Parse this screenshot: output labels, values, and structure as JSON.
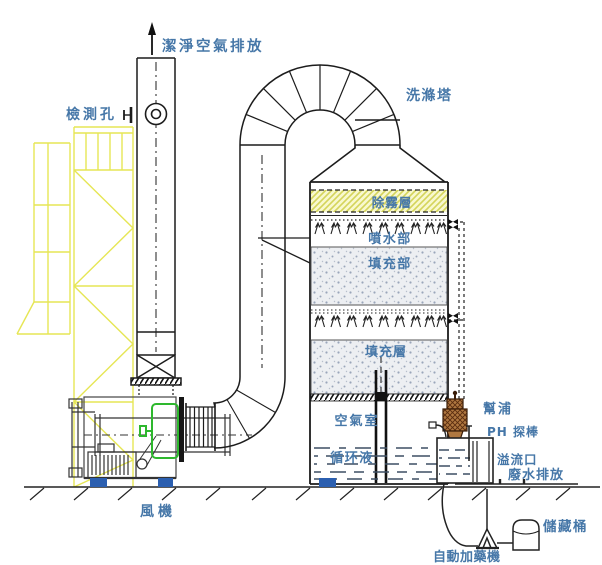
{
  "diagram_title": "洗滌塔",
  "labels": {
    "clean_air_outlet": "潔淨空氣排放",
    "inspection_port": "檢測孔",
    "scrubber_tower": "洗滌塔",
    "demister_layer": "除霧層",
    "spray_section": "噴水部",
    "packing_section": "填充部",
    "packing_layer": "填充層",
    "air_chamber": "空氣室",
    "circulating_liquid": "循环液",
    "pump": "幫浦",
    "ph_probe": "PH 探棒",
    "overflow_port": "溢流口",
    "wastewater_discharge": "廢水排放",
    "fan": "風機",
    "storage_tank": "儲藏桶",
    "auto_dosing_machine": "自動加藥機"
  },
  "colors": {
    "label_text": "#4677a8",
    "line": "#1c1c1c",
    "structure_yellow": "#e6e655",
    "highlight_green": "#2eb82e",
    "mount_blue": "#2b5fb0",
    "pump_body": "#b07840",
    "pump_hatch": "#5a2d10",
    "demister_fill": "#f8f8ce",
    "demister_hatch": "#d4d45a",
    "packing_fill": "#edeff2",
    "packing_dot": "#9aa6ba",
    "water_dash": "#3d4f63"
  }
}
